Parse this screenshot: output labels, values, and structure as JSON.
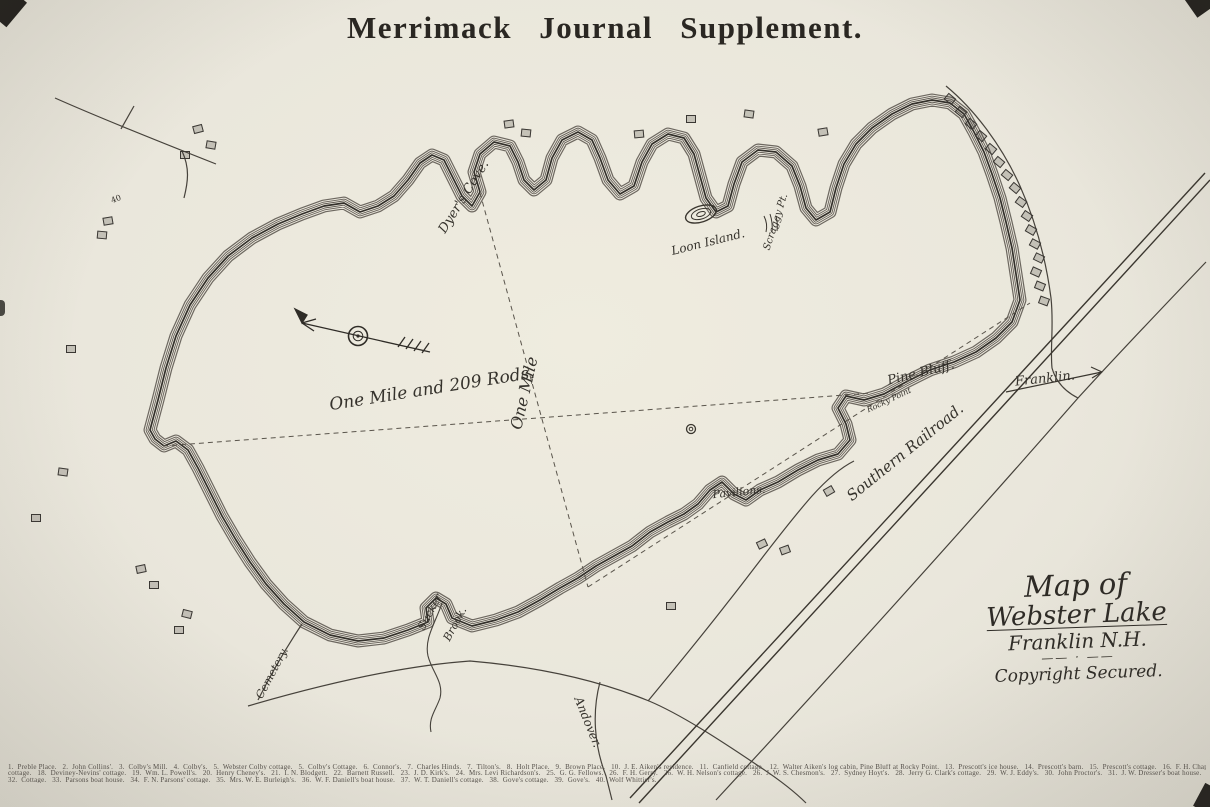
{
  "title": "Merrimack Journal Supplement.",
  "cartouche": {
    "line1": "Map of",
    "line2": "Webster Lake",
    "line3": "Franklin N.H.",
    "flourish": "—— · ——",
    "line4": "Copyright Secured."
  },
  "scale": {
    "horizontal": "One Mile and 209 Rods.",
    "vertical": "One Mile"
  },
  "labels": {
    "dyers_cove": "Dyer's Cove.",
    "loon_island": "Loon Island.",
    "scraggy_point": "Scraggy Pt.",
    "pine_bluff": "Pine Bluff.",
    "rocky_point": "Rocky Point",
    "pavilions": "Pavilions.",
    "southern_railroad": "Southern Railroad.",
    "franklin": "Franklin.",
    "andover": "Andover.",
    "cemetery": "Cemetery.",
    "sucker": "Sucker",
    "brook": "Brook.",
    "number_40": "40"
  },
  "legend": {
    "line1": "1.  Preble Place.   2.  John Collins'.   3.  Colby's Mill.   4.  Colby's.   5.  Webster Colby cottage.   5.  Colby's Cottage.   6.  Connor's.   7.  Charles Hinds.   7.  Tilton's.   8.  Holt Place.   9.  Brown Place.   10.  J. E. Aiken's residence.   11.  Canfield cottage.   12.  Walter Aiken's log cabin, Pine Bluff at Rocky Point.   13.  Prescott's ice house.   14.  Prescott's barn.   15.  Prescott's cottage.   16.  F. H. Chapman's",
    "line2": "cottage.   18.  Deviney-Nevins' cottage.   19.  Wm. L. Powell's.   20.  Henry Cheney's.   21.  I. N. Blodgett.   22.  Barnett Russell.   23.  J. D. Kirk's.   24.  Mrs. Levi Richardson's.   25.  G. G. Fellows.   26.  F. H. Gerry.   26.  W. H. Nelson's cottage.   26.  J. W. S. Chesmon's.   27.  Sydney Hoyt's.   28.  Jerry G. Clark's cottage.   29.  W. J. Eddy's.   30.  John Proctor's.   31.  J. W. Dresser's boat house.",
    "line3": "32.  Cottage.   33.  Parsons boat house.   34.  F. N. Parsons' cottage.   35.  Mrs. W. E. Burleigh's.   36.  W. F. Daniell's boat house.   37.  W. T. Daniell's cottage.   38.  Gove's cottage.   39.  Gove's.   40.  Wolf Whittier's."
  },
  "colors": {
    "paper": "#eae7dc",
    "ink": "#3a362f",
    "shore_band": "#565049"
  },
  "map": {
    "buildings": [
      [
        193,
        125,
        -15
      ],
      [
        206,
        141,
        10
      ],
      [
        180,
        151,
        0
      ],
      [
        103,
        217,
        -10
      ],
      [
        97,
        231,
        5
      ],
      [
        66,
        345,
        0
      ],
      [
        58,
        468,
        8
      ],
      [
        31,
        514,
        0
      ],
      [
        136,
        565,
        -12
      ],
      [
        149,
        581,
        0
      ],
      [
        182,
        610,
        14
      ],
      [
        174,
        626,
        0
      ],
      [
        504,
        120,
        -8
      ],
      [
        521,
        129,
        6
      ],
      [
        634,
        130,
        -5
      ],
      [
        686,
        115,
        0
      ],
      [
        744,
        110,
        8
      ],
      [
        818,
        128,
        -10
      ],
      [
        945,
        95,
        40
      ],
      [
        956,
        108,
        40
      ],
      [
        966,
        120,
        40
      ],
      [
        976,
        132,
        40
      ],
      [
        986,
        145,
        40
      ],
      [
        994,
        158,
        40
      ],
      [
        1002,
        171,
        40
      ],
      [
        1010,
        184,
        40
      ],
      [
        1016,
        198,
        36
      ],
      [
        1022,
        212,
        34
      ],
      [
        1026,
        226,
        30
      ],
      [
        1030,
        240,
        28
      ],
      [
        1034,
        254,
        26
      ],
      [
        1031,
        268,
        24
      ],
      [
        1035,
        282,
        22
      ],
      [
        1039,
        297,
        20
      ],
      [
        666,
        602,
        0
      ],
      [
        780,
        546,
        -20
      ],
      [
        824,
        487,
        -30
      ],
      [
        757,
        540,
        -25
      ]
    ]
  }
}
